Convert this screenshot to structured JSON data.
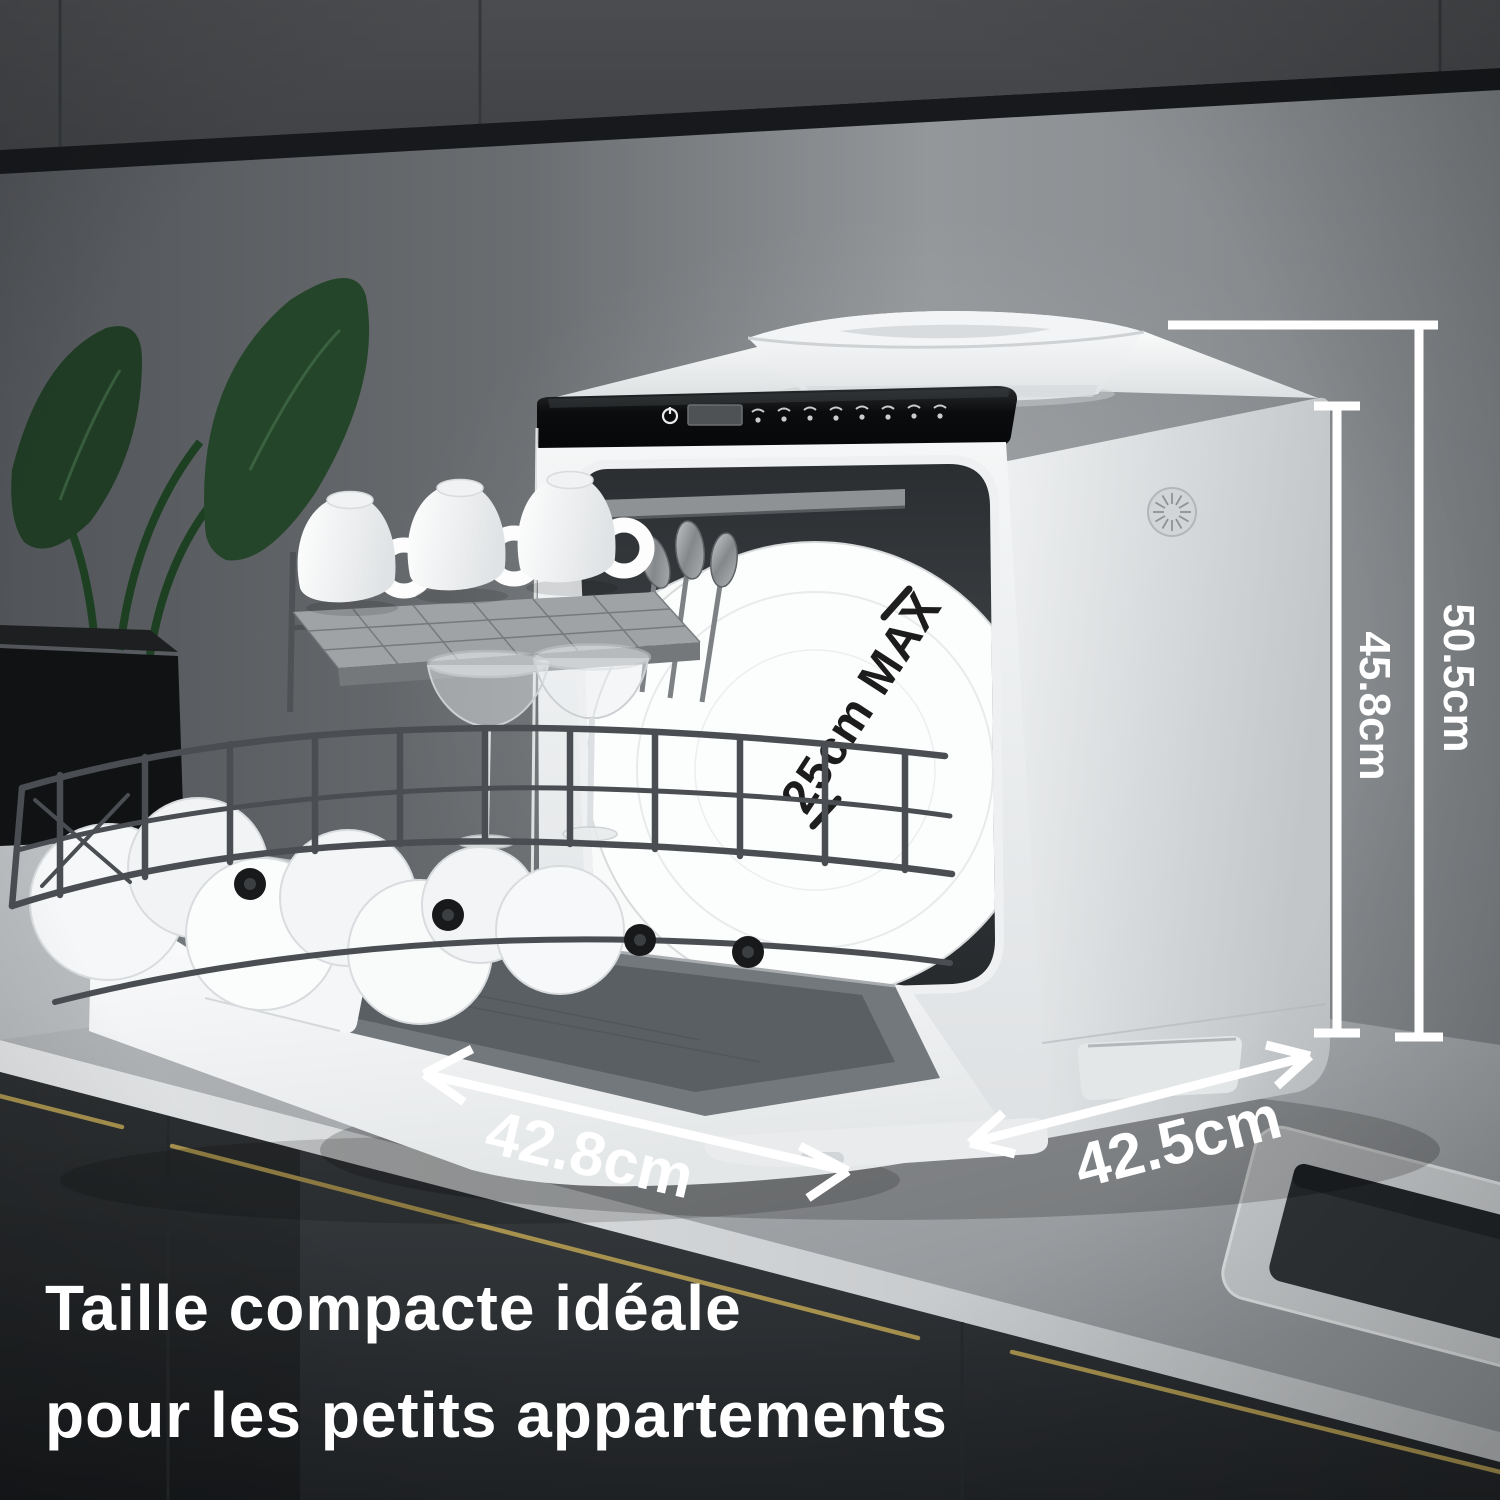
{
  "image_type": "product-marketing-photo",
  "caption": {
    "line1": "Taille compacte idéale",
    "line2": "pour les petits appartements"
  },
  "annotations": {
    "height_total": "50.5cm",
    "height_body": "45.8cm",
    "width_front": "42.8cm",
    "depth_side": "42.5cm",
    "plate_max": "25cm MAX"
  },
  "control_panel": {
    "icons": [
      "power-icon",
      "display-screen",
      "program-icon-1",
      "program-icon-2",
      "program-icon-3",
      "program-icon-4",
      "program-icon-5",
      "program-icon-6",
      "program-icon-7",
      "program-icon-8"
    ]
  },
  "colors": {
    "annotation_text": "#ffffff",
    "plate_annotation_text": "#1c1c1d",
    "machine_body": "#f2f4f5",
    "control_panel": "#0a0b0c",
    "brass_handle": "#a6914e",
    "cabinet_dark": "#46484b",
    "leaf_green": "#24452a"
  }
}
